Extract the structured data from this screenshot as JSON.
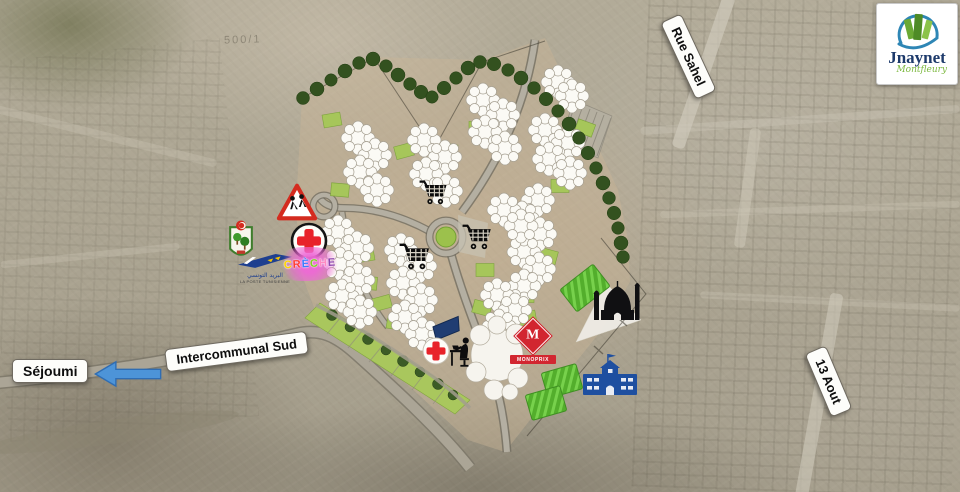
{
  "logo": {
    "title": "Jnaynet",
    "tagline": "Montfleury"
  },
  "road_labels": {
    "rue_sahel": "Rue Sahel",
    "sejoumi": "Séjoumi",
    "intercommunal_sud": "Intercommunal Sud",
    "treize_aout": "13 Aout"
  },
  "poi": {
    "creche": "CRÈCHE",
    "monoprix_initial": "M",
    "monoprix_name": "MONOPRIX",
    "poste_arabic": "البريد التونسي",
    "poste_french": "LA POSTE TUNISIENNE"
  },
  "watermark": {
    "scale_note": "500/1"
  },
  "icons": {
    "supermarket": "shopping-cart-icon",
    "mosque": "mosque-icon",
    "school": "school-icon",
    "clinic": "red-cross-icon",
    "kids_crossing": "children-crossing-sign",
    "post_office": "la-poste-logo",
    "municipality": "municipal-emblem-icon",
    "office": "person-at-desk-icon",
    "direction_west": "left-arrow-icon"
  },
  "colors": {
    "arrow_blue": "#4d94d8",
    "tree_green": "#33511f",
    "parcel_green": "#a6c65a",
    "field_green": "#57b12e",
    "school_blue": "#1e4fa0",
    "monoprix_red": "#d22630",
    "logo_navy": "#1d3a6b",
    "logo_green": "#7cb83f",
    "creche_palette": [
      "#ffd400",
      "#ff3b30",
      "#3b7cff",
      "#7ed321",
      "#ff8ac2",
      "#8e44ad"
    ]
  }
}
